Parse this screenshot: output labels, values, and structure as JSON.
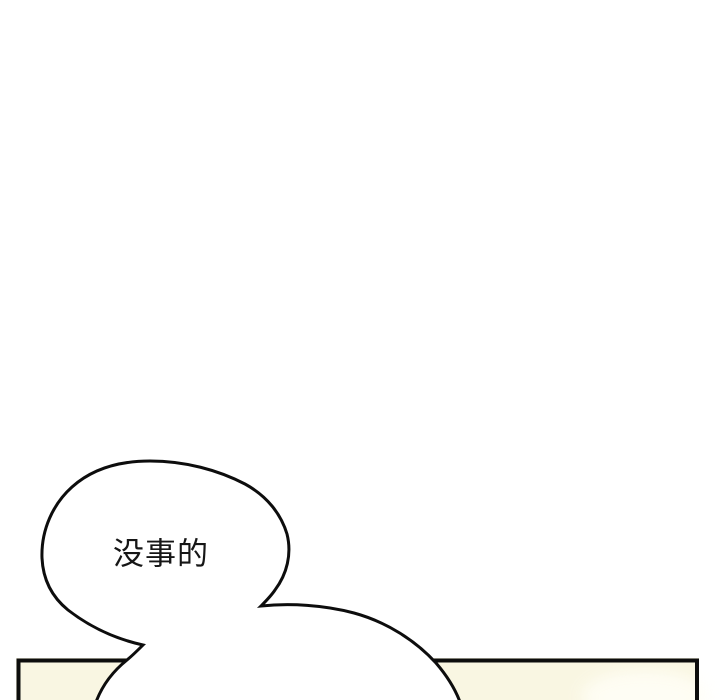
{
  "page": {
    "type": "comic-panel"
  },
  "bubble": {
    "text": "没事的"
  },
  "colors": {
    "background": "#ffffff",
    "outline": "#0d0d0d",
    "panel_fill": "#f9f6e2",
    "panel_highlight": "#fffef6",
    "bubble_fill": "#ffffff"
  }
}
